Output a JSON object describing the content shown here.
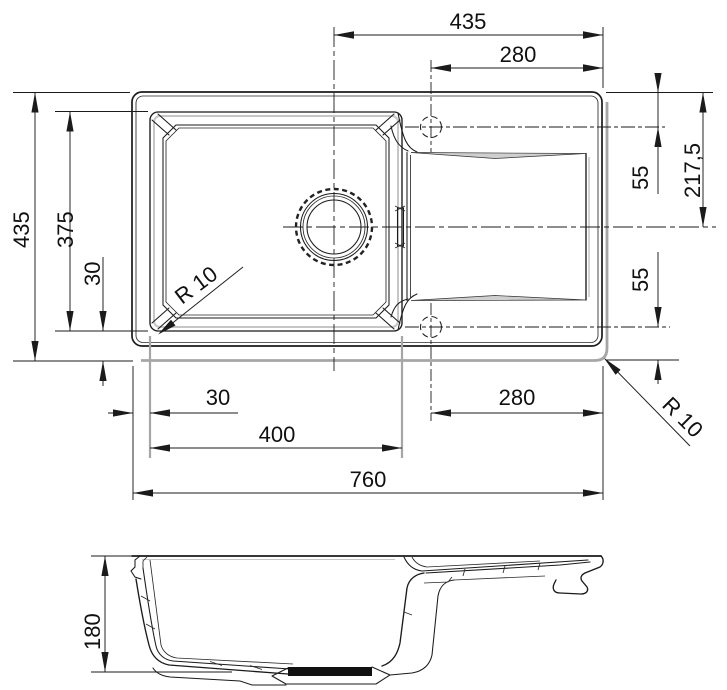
{
  "drawing": {
    "subject": "kitchen sink technical drawing, top view and section view",
    "colors": {
      "line": "#1b1b1b",
      "shadow": "#a6a6a6",
      "background": "#ffffff"
    },
    "top_view": {
      "labels": {
        "width_center_to_right": "435",
        "width_faucet_to_right_top": "280",
        "edge_to_faucet_top": "55",
        "half_depth": "217,5",
        "faucet_to_edge_bottom": "55",
        "overall_depth": "435",
        "bowl_depth": "375",
        "bowl_to_edge_left": "30",
        "edge_to_bowl_bottom": "30",
        "bowl_width": "400",
        "faucet_to_right_bottom": "280",
        "overall_width": "760",
        "bowl_corner_radius": "R 10",
        "sink_corner_radius": "R 10"
      }
    },
    "section_view": {
      "labels": {
        "depth": "180"
      }
    }
  }
}
